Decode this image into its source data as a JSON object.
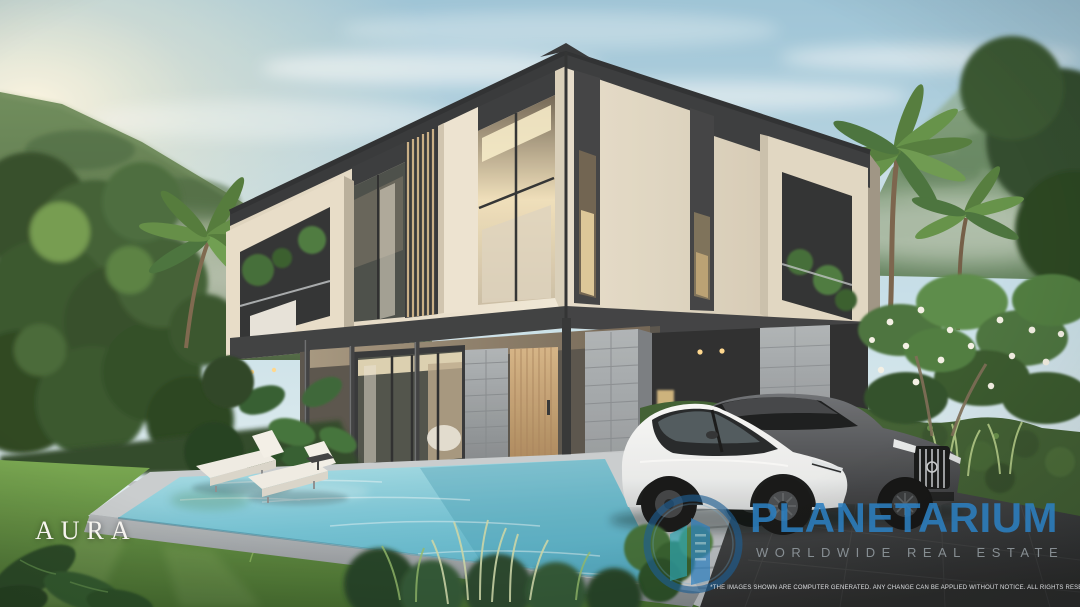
{
  "branding": {
    "project_name": "AURA"
  },
  "watermark": {
    "brand": "PLANETARIUM",
    "tagline": "WORLDWIDE REAL ESTATE",
    "disclaimer": "*THE IMAGES SHOWN ARE COMPUTER GENERATED. ANY CHANGE CAN BE APPLIED WITHOUT NOTICE. ALL RIGHTS RESERVED",
    "colors": {
      "brand_blue": "#2c7fc0",
      "logo_navy": "#1d5e92",
      "logo_teal": "#2ea7b4",
      "tagline_gray": "#8e969b"
    }
  },
  "scene": {
    "type": "architectural-exterior-render",
    "objects": [
      "modern two-storey pool villa",
      "swimming pool",
      "sun loungers",
      "white electric suv",
      "dark gray suv",
      "tropical garden",
      "palm trees",
      "forested mountains",
      "green hedge",
      "lawn"
    ],
    "palette": {
      "sky": "#a7cfe2",
      "mountain": "#5d7c50",
      "facade_cream": "#e8e0cf",
      "facade_charcoal": "#35383c",
      "wood_door": "#c9a878",
      "stone_gray": "#9aa0a5",
      "pool_water": "#6fc0d4",
      "lawn_green": "#5c8f3d",
      "driveway": "#33373b"
    }
  }
}
